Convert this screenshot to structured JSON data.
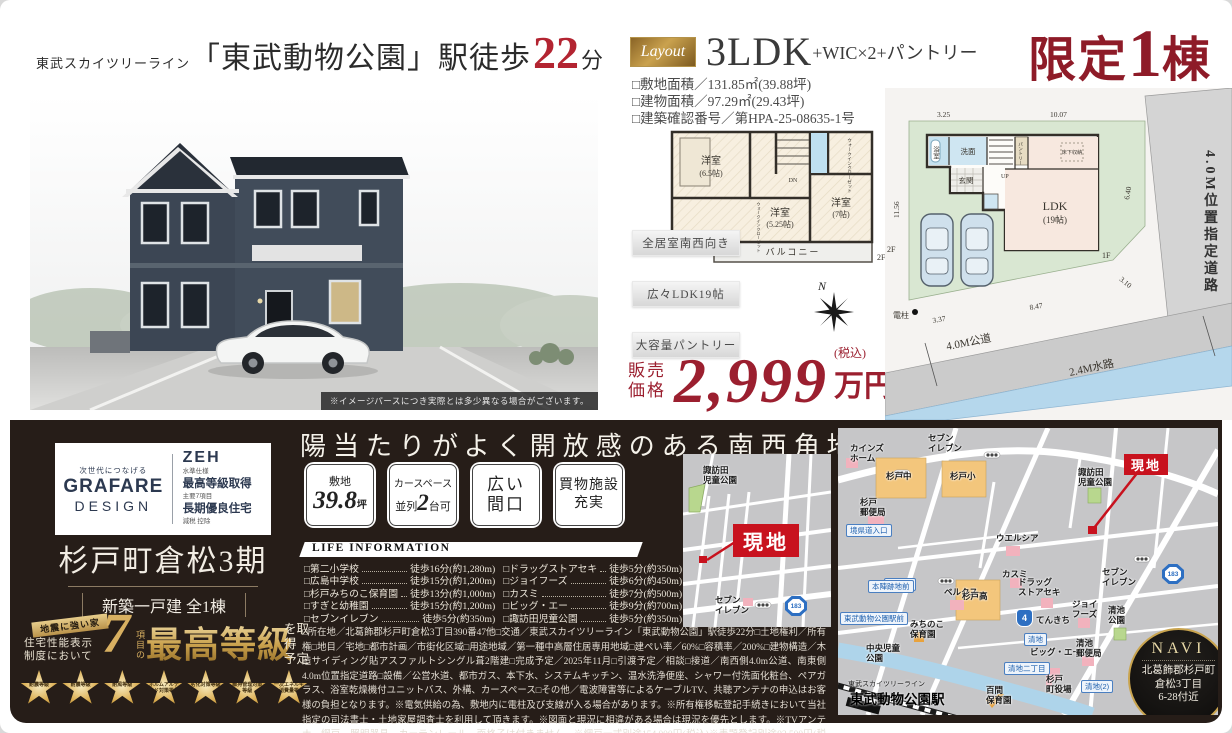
{
  "header": {
    "line_small": "東武スカイツリーライン",
    "station": "「東武動物公園」駅徒歩",
    "minutes": "22",
    "unit": "分"
  },
  "render": {
    "caption": "※イメージパースにつき実際とは多少異なる場合がございます。"
  },
  "layout": {
    "badge": "Layout",
    "type": "3LDK",
    "suffix": "+WIC×2+パントリー",
    "specs": "□敷地面積／131.85㎡(39.88坪)\n□建物面積／97.29㎡(29.43坪)\n□建築確認番号／第HPA-25-08635-1号"
  },
  "limited": {
    "prefix": "限定",
    "num": "1",
    "suffix": "棟"
  },
  "features": [
    "全居室南西向き",
    "広々LDK19帖",
    "大容量パントリー"
  ],
  "price": {
    "label": "販売\n価格",
    "amount": "2,999",
    "tax": "(税込)",
    "unit": "万円"
  },
  "compass": {
    "n": "N"
  },
  "plan2f": {
    "room1": "洋室",
    "room1_size": "(6.5帖)",
    "room2": "洋室",
    "room2_size": "(5.25帖)",
    "room3": "洋室",
    "room3_size": "(7帖)",
    "balcony": "バルコニー",
    "dn": "DN",
    "wic": "ウォークインクローゼット",
    "floor": "2F"
  },
  "siteplan": {
    "bath": "浴室",
    "wash": "洗面",
    "entrance": "玄関",
    "up": "UP",
    "pantry": "パントリー",
    "underfloor": "床下収納",
    "ldk": "LDK",
    "ldk_size": "(19帖)",
    "f1": "1F",
    "f2": "2F",
    "pole": "電柱",
    "dim_top1": "3.25",
    "dim_top2": "10.07",
    "dim_left": "11.56",
    "dim_right": "6.40",
    "dim_diag": "3.10",
    "dim_bottom": "8.47",
    "dim_bl": "3.37",
    "road_right": "4.0M位置指定道路",
    "road_bottom": "4.0M公道",
    "water": "2.4M水路"
  },
  "brand": {
    "tagline": "次世代につなげる",
    "name": "GRAFARE",
    "name2": "DESIGN",
    "zeh": "ZEH",
    "zeh_sub": "水準仕様",
    "item2": "最高等級取得",
    "item2_sub": "主要7項目",
    "item3": "長期優良住宅",
    "item3_sub": "減税 控除"
  },
  "project": {
    "title": "杉戸町倉松3期",
    "subtitle": "新築一戸建 全1棟"
  },
  "grade7": {
    "ribbon": "地震に強い家",
    "ctx": "住宅性能表示\n制度において",
    "num": "7",
    "num_label": "項目の",
    "highlight": "最高等級",
    "tail": "を取得\n予定",
    "stars": [
      "耐震等級",
      "耐震等級",
      "耐風等級",
      "ホルムアルデヒド対策等級",
      "劣化対策等級",
      "維持管理対策等級",
      "一次エネルギー消費量等級"
    ]
  },
  "southwest": {
    "heading": "陽当たりがよく開放感のある南西角地",
    "badges": [
      {
        "top": "敷地",
        "big": "39.8",
        "unit": "坪"
      },
      {
        "top": "カースペース",
        "pre": "並列",
        "big": "2",
        "post": "台可"
      },
      {
        "line1": "広い",
        "line2": "間口"
      },
      {
        "line1": "買物施設",
        "line2": "充実"
      }
    ]
  },
  "life_info": {
    "title": "LIFE INFORMATION",
    "left": [
      {
        "name": "□第二小学校",
        "value": "徒歩16分(約1,280m)"
      },
      {
        "name": "□広島中学校",
        "value": "徒歩15分(約1,200m)"
      },
      {
        "name": "□杉戸みちのこ保育園",
        "value": "徒歩13分(約1,000m)"
      },
      {
        "name": "□すぎと幼稚園",
        "value": "徒歩15分(約1,200m)"
      },
      {
        "name": "□セブンイレブン",
        "value": "徒歩5分(約350m)"
      }
    ],
    "right": [
      {
        "name": "□ドラッグストアセキ",
        "value": "徒歩5分(約350m)"
      },
      {
        "name": "□ジョイフーズ",
        "value": "徒歩6分(約450m)"
      },
      {
        "name": "□カスミ",
        "value": "徒歩7分(約500m)"
      },
      {
        "name": "□ビッグ・エー",
        "value": "徒歩9分(約700m)"
      },
      {
        "name": "□諏訪田児童公園",
        "value": "徒歩5分(約350m)"
      }
    ]
  },
  "legal": "□所在地／北葛飾郡杉戸町倉松3丁目390番47他□交通／東武スカイツリーライン「東武動物公園」駅徒歩22分□土地権利／所有権□地目／宅地□都市計画／市街化区域□用途地域／第一種中高層住居専用地域□建ぺい率／60%□容積率／200%□建物構造／木造サイディング貼アスファルトシングル葺2階建□完成予定／2025年11月□引渡予定／相談□接道／南西側4.0m公道、南東側4.0m位置指定道路□設備／公営水道、都市ガス、本下水、システムキッチン、温水洗浄便座、シャワー付洗面化粧台、ペアガラス、浴室乾燥機付ユニットバス、外構、カースペース□その他／電波障害等によるケーブルTV、共聴アンテナの申込はお客様の負担となります。※電気供給の為、敷地内に電柱及び支線が入る場合があります。※所有権移転登記手続きにおいて当社指定の司法書士・土地家屋調査士を利用して頂きます。※図面と現況に相違がある場合は現況を優先とします。※TVアンテナ、網戸、照明器具、カーテンレール、面格子は付きません。※網戸一式別途154,000円(税込)※表題登記別途93,500円(税込)※フラット35ご利用の場合における各証明書取得代金が別途必要になります。",
  "small_map": {
    "labels": [
      {
        "text": "諏訪田\n児童公園",
        "x": 20,
        "y": 12,
        "type": "place"
      },
      {
        "text": "現地",
        "x": 50,
        "y": 70,
        "type": "genchi-big"
      },
      {
        "text": "セブン\nイレブン",
        "x": 32,
        "y": 142,
        "type": "place"
      },
      {
        "text": "183",
        "x": 102,
        "y": 142,
        "type": "badge183"
      }
    ]
  },
  "main_map": {
    "labels": [
      {
        "text": "カインズ\nホーム",
        "x": 12,
        "y": 16,
        "type": "place"
      },
      {
        "text": "セブン\nイレブン",
        "x": 90,
        "y": 6,
        "type": "place"
      },
      {
        "text": "杉戸中",
        "x": 48,
        "y": 44,
        "type": "place"
      },
      {
        "text": "杉戸小",
        "x": 112,
        "y": 44,
        "type": "place"
      },
      {
        "text": "杉戸\n郵便局",
        "x": 22,
        "y": 70,
        "type": "place"
      },
      {
        "text": "境県道入口",
        "x": 8,
        "y": 96,
        "type": "blue"
      },
      {
        "text": "杉戸(2)",
        "x": 46,
        "y": 150,
        "type": "blue"
      },
      {
        "text": "ウエルシア",
        "x": 158,
        "y": 106,
        "type": "place"
      },
      {
        "text": "諏訪田\n児童公園",
        "x": 240,
        "y": 40,
        "type": "place"
      },
      {
        "text": "現地",
        "x": 286,
        "y": 26,
        "type": "genchi"
      },
      {
        "text": "カスミ",
        "x": 164,
        "y": 142,
        "type": "place"
      },
      {
        "text": "ベルクス",
        "x": 106,
        "y": 160,
        "type": "place"
      },
      {
        "text": "本陣跡地前",
        "x": 30,
        "y": 152,
        "type": "blue"
      },
      {
        "text": "杉戸高",
        "x": 124,
        "y": 164,
        "type": "place"
      },
      {
        "text": "4",
        "x": 178,
        "y": 181,
        "type": "badge4"
      },
      {
        "text": "てんきち",
        "x": 198,
        "y": 188,
        "type": "place"
      },
      {
        "text": "ドラッグ\nストアセキ",
        "x": 180,
        "y": 150,
        "type": "place"
      },
      {
        "text": "ジョイ\nフーズ",
        "x": 234,
        "y": 172,
        "type": "place"
      },
      {
        "text": "清池\n公園",
        "x": 270,
        "y": 178,
        "type": "place"
      },
      {
        "text": "セブン\nイレブン",
        "x": 264,
        "y": 140,
        "type": "place"
      },
      {
        "text": "183",
        "x": 324,
        "y": 136,
        "type": "badge183"
      },
      {
        "text": "清地",
        "x": 186,
        "y": 205,
        "type": "blue"
      },
      {
        "text": "ビッグ・エー",
        "x": 192,
        "y": 220,
        "type": "place"
      },
      {
        "text": "清池\n郵便局",
        "x": 238,
        "y": 211,
        "type": "place"
      },
      {
        "text": "清地二丁目",
        "x": 166,
        "y": 234,
        "type": "blue"
      },
      {
        "text": "杉戸\n町役場",
        "x": 208,
        "y": 247,
        "type": "place"
      },
      {
        "text": "清地(2)",
        "x": 243,
        "y": 252,
        "type": "blue"
      },
      {
        "text": "東武動物公園駅前",
        "x": 2,
        "y": 184,
        "type": "blue"
      },
      {
        "text": "みちのこ\n保育園",
        "x": 72,
        "y": 192,
        "type": "place"
      },
      {
        "text": "中央児童\n公園",
        "x": 28,
        "y": 216,
        "type": "place"
      },
      {
        "text": "東武スカイツリーライン",
        "x": 10,
        "y": 251,
        "type": "small"
      },
      {
        "text": "東武動物公園駅",
        "x": 12,
        "y": 260,
        "type": "station"
      },
      {
        "text": "百間\n保育園",
        "x": 148,
        "y": 258,
        "type": "place"
      }
    ]
  },
  "navi": {
    "title": "NAVI",
    "line1": "北葛飾郡杉戸町",
    "line2": "倉松3丁目",
    "line3": "6-28付近"
  }
}
